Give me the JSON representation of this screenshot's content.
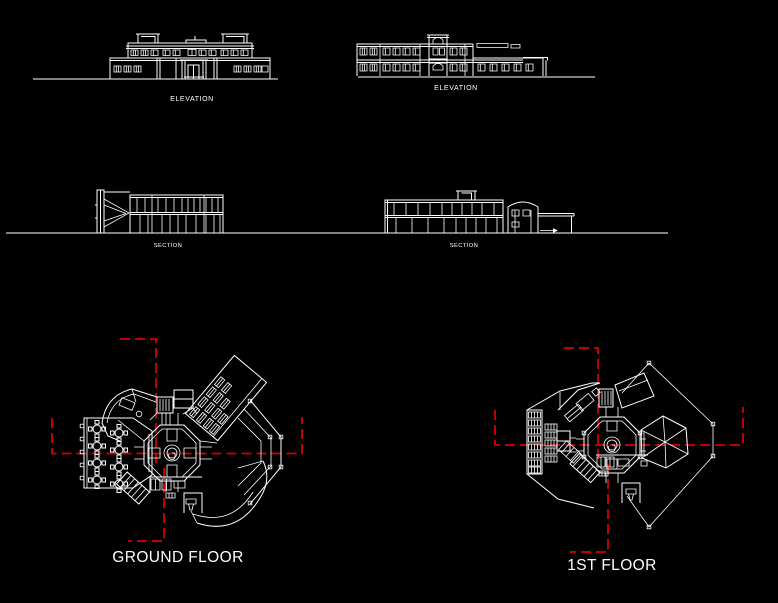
{
  "colors": {
    "background": "#000000",
    "line": "#ffffff",
    "centerline": "#d40000",
    "text": "#ffffff"
  },
  "sheet": {
    "elevation_left_label": "ELEVATION",
    "elevation_right_label": "ELEVATION",
    "section_left_label": "SECTION",
    "section_right_label": "SECTION",
    "ground_floor_label": "GROUND FLOOR",
    "first_floor_label": "1ST FLOOR"
  }
}
